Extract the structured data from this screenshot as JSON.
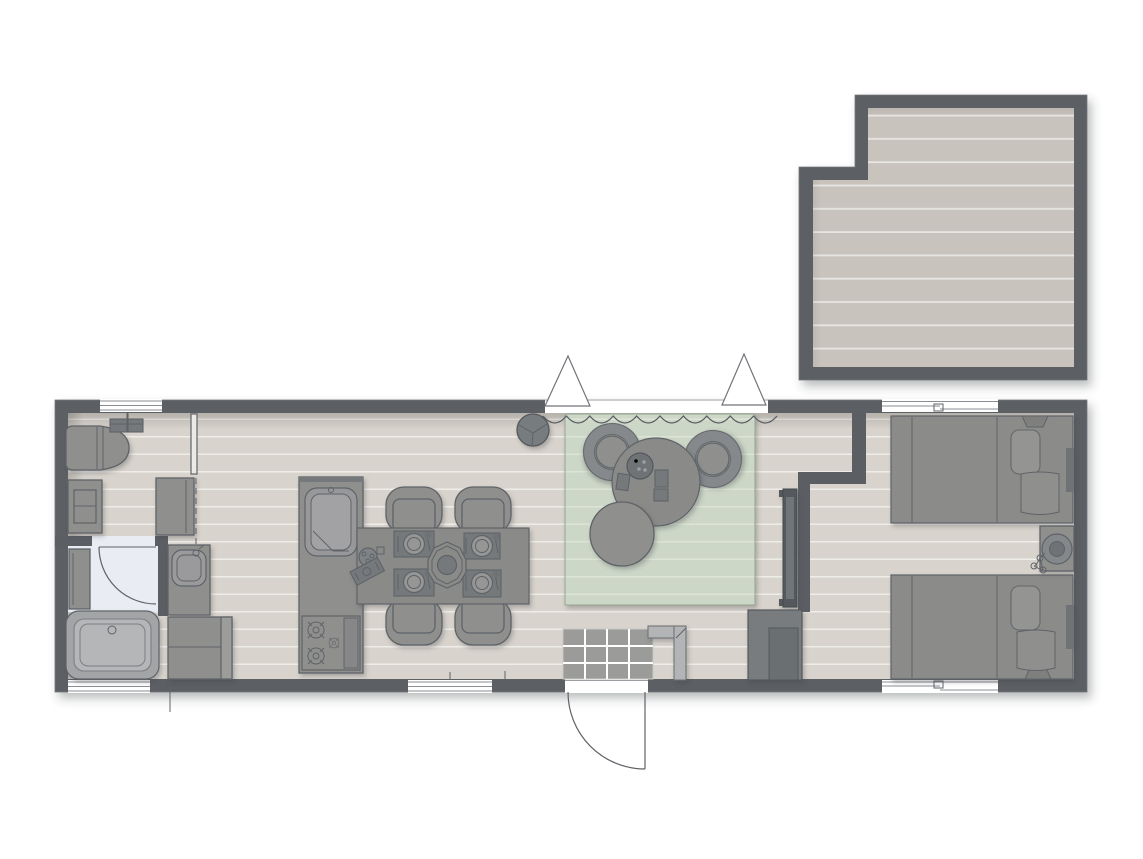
{
  "meta": {
    "kind": "architectural-floor-plan",
    "description": "Top-down floor plan of a long single-storey holiday lodge with a detached deck at the upper right; no text labels are rendered in the drawing"
  },
  "colors": {
    "background": "#ffffff",
    "wall": "#5b5f64",
    "wall_edge": "#74787d",
    "floor": "#d8d3cc",
    "floor_line": "#efede9",
    "deck_floor": "#c9c3bd",
    "deck_line": "#e8e6e2",
    "furn": "#8f8f8d",
    "furn_dark": "#75797c",
    "outline": "#5f6368",
    "rug": "#ccd7c7",
    "rug_line": "#dbe4d5",
    "rug_edge": "#97a591",
    "bath_floor": "#e9edf3",
    "tile": "#9b9b99",
    "fixture": "#b2b4b6",
    "window": "#ffffff"
  },
  "areas": {
    "deck": {
      "elements": [
        "plank-decking",
        "perimeter-wall",
        "notched-corner"
      ]
    },
    "lounge_corner": {
      "elements": [
        "lounge-chair",
        "wall-fixture",
        "dresser",
        "tall-cabinet",
        "thin-partition",
        "sliding-door-dashed"
      ]
    },
    "bathroom": {
      "elements": [
        "swing-door",
        "wall-shelf",
        "bathtub",
        "vanity-basin",
        "appliance-cabinet"
      ]
    },
    "kitchen": {
      "elements": [
        "counter",
        "sink",
        "cutting-board",
        "stove-burners"
      ]
    },
    "dining": {
      "elements": [
        "table",
        "chair-x4",
        "place-setting-x4",
        "centerpiece-octagon",
        "table-plant",
        "serving-tray"
      ]
    },
    "living": {
      "elements": [
        "green-rug",
        "curtain-wave",
        "awning-triangle-x2",
        "pendant-ball",
        "armchair-x2",
        "coffee-table",
        "pouf",
        "decor-items",
        "wall-tv"
      ]
    },
    "entry": {
      "elements": [
        "entry-door-swing",
        "tile-mat",
        "coat-stand",
        "wardrobe"
      ]
    },
    "bedroom": {
      "elements": [
        "partition-z-wall",
        "bed-x2",
        "pillow-x2",
        "folded-blanket-x2",
        "nightstand",
        "round-lamp",
        "plant",
        "window-x2"
      ]
    }
  },
  "windows": {
    "count": 5,
    "openings": [
      "living-curtain-opening",
      "entry-door-opening",
      "bathroom-door-opening",
      "bedroom-doorway"
    ]
  }
}
